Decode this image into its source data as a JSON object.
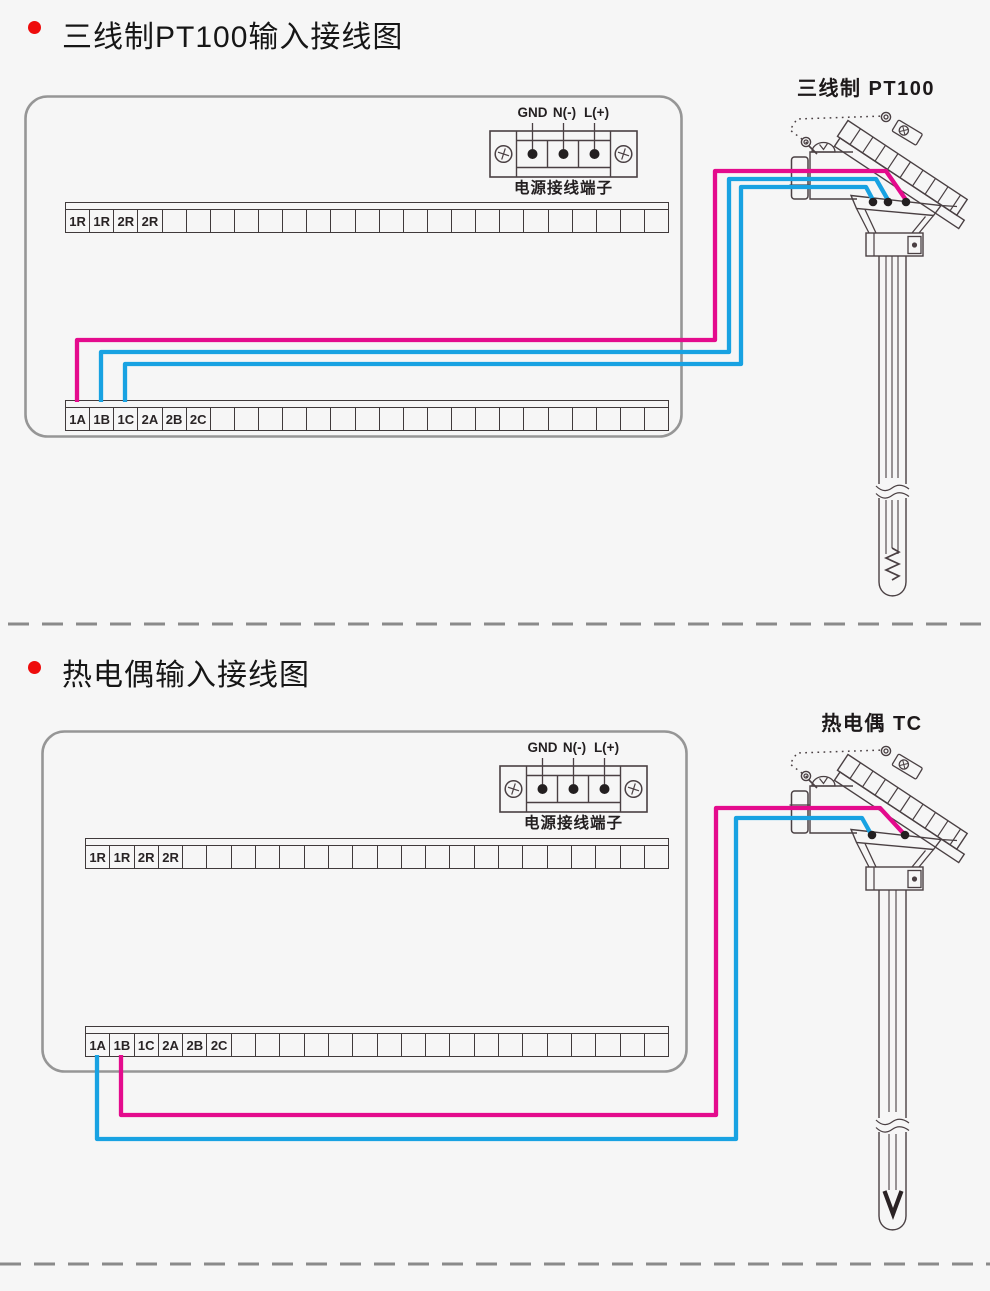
{
  "palette": {
    "background": "#f6f6f6",
    "bullet_red": "#ee0c0c",
    "line_dark": "#4a4043",
    "box_border": "#969696",
    "divider_gray": "#8a8a8a",
    "wire_pink": "#e40b8d",
    "wire_blue": "#18a2e2",
    "dot_black": "#231f20"
  },
  "sections": [
    {
      "title": "三线制PT100输入接线图",
      "sensor_label": "三线制 PT100",
      "power": {
        "labels": [
          "GND",
          "N(-)",
          "L(+)"
        ],
        "caption": "电源接线端子"
      },
      "strip_r": {
        "labels": [
          "1R",
          "1R",
          "2R",
          "2R"
        ],
        "total": 25
      },
      "strip_a": {
        "labels": [
          "1A",
          "1B",
          "1C",
          "2A",
          "2B",
          "2C"
        ],
        "total": 25
      }
    },
    {
      "title": "热电偶输入接线图",
      "sensor_label": "热电偶 TC",
      "power": {
        "labels": [
          "GND",
          "N(-)",
          "L(+)"
        ],
        "caption": "电源接线端子"
      },
      "strip_r": {
        "labels": [
          "1R",
          "1R",
          "2R",
          "2R"
        ],
        "total": 24
      },
      "strip_a": {
        "labels": [
          "1A",
          "1B",
          "1C",
          "2A",
          "2B",
          "2C"
        ],
        "total": 24
      }
    }
  ]
}
